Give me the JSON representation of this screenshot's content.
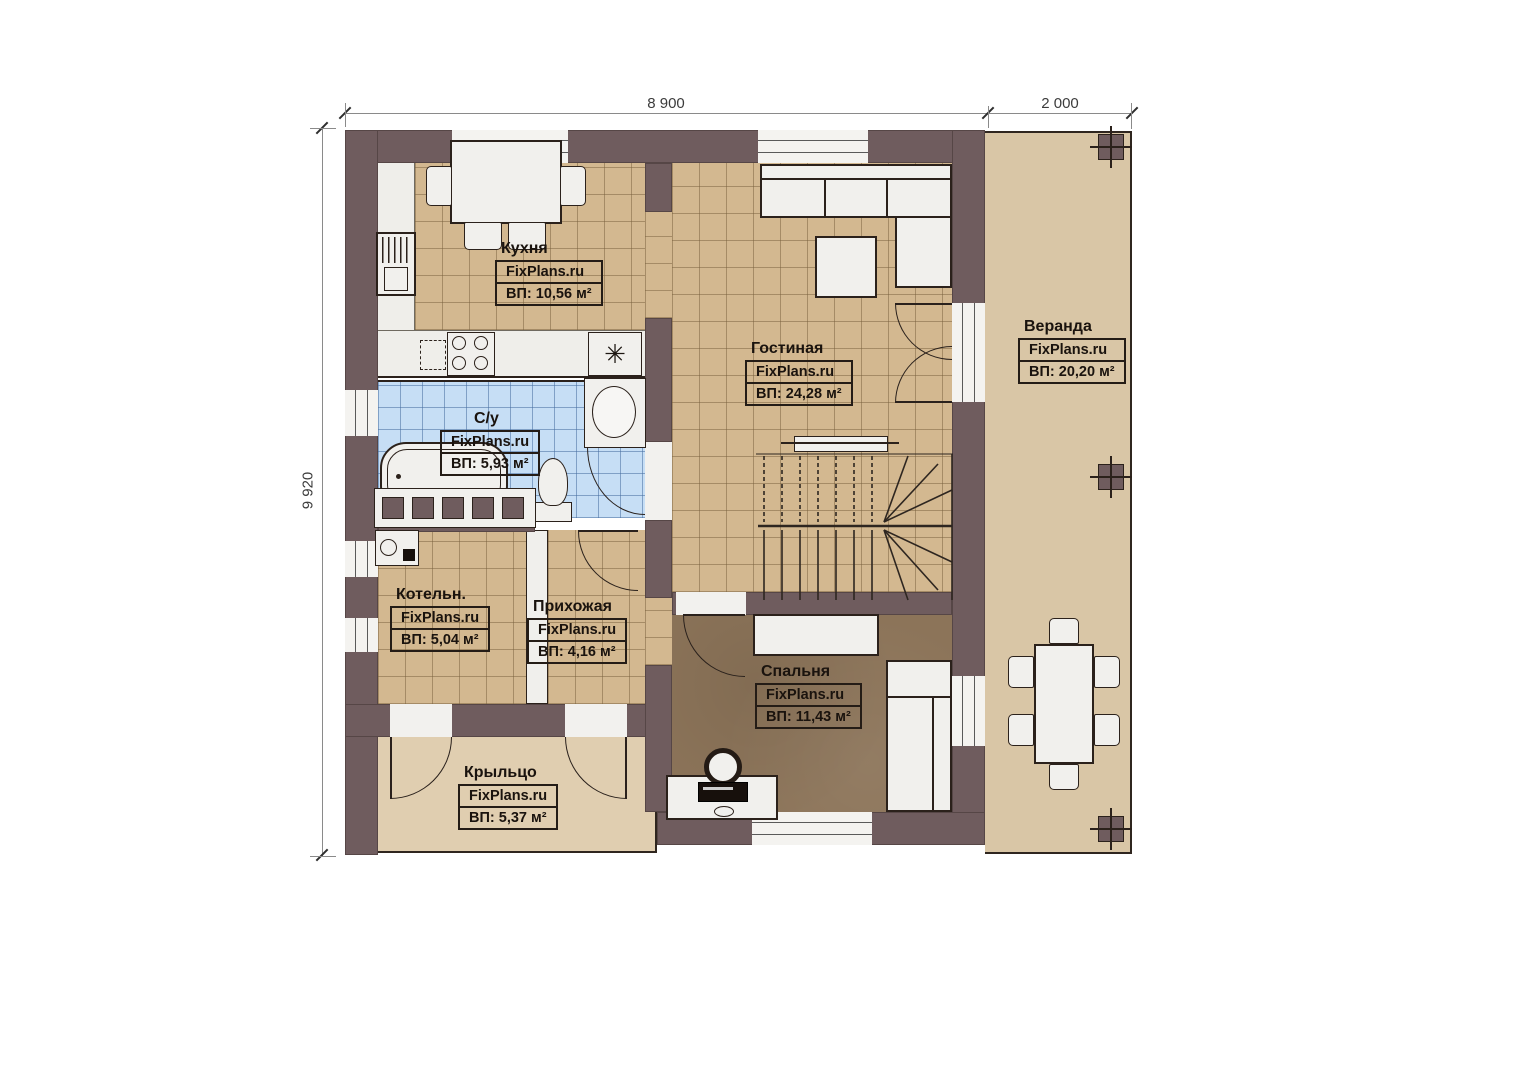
{
  "plan": {
    "brand": "FixPlans.ru",
    "dimensions": {
      "top_main": "8 900",
      "top_veranda": "2 000",
      "left": "9 920"
    },
    "rooms": [
      {
        "id": "kitchen",
        "name": "Кухня",
        "watermark": "FixPlans.ru",
        "area": "ВП: 10,56 м²"
      },
      {
        "id": "living",
        "name": "Гостиная",
        "watermark": "FixPlans.ru",
        "area": "ВП: 24,28 м²"
      },
      {
        "id": "veranda",
        "name": "Веранда",
        "watermark": "FixPlans.ru",
        "area": "ВП: 20,20 м²"
      },
      {
        "id": "bathroom",
        "name": "С/у",
        "watermark": "FixPlans.ru",
        "area": "ВП: 5,93 м²"
      },
      {
        "id": "boiler",
        "name": "Котельн.",
        "watermark": "FixPlans.ru",
        "area": "ВП: 5,04 м²"
      },
      {
        "id": "hallway",
        "name": "Прихожая",
        "watermark": "FixPlans.ru",
        "area": "ВП: 4,16 м²"
      },
      {
        "id": "bedroom",
        "name": "Спальня",
        "watermark": "FixPlans.ru",
        "area": "ВП: 11,43 м²"
      },
      {
        "id": "porch",
        "name": "Крыльцо",
        "watermark": "FixPlans.ru",
        "area": "ВП: 5,37 м²"
      }
    ],
    "fixtures": {
      "sink_symbol": "✳"
    },
    "colors": {
      "wall": "#6f5c5e",
      "floor_tile_tan": "#d3b890",
      "floor_tile_blue": "#c6def5",
      "floor_bedroom": "#8c7459",
      "floor_veranda": "#d9c6a6",
      "floor_porch": "#e0ceb0",
      "furniture": "#f1f0ed",
      "outline": "#2b211b"
    }
  }
}
